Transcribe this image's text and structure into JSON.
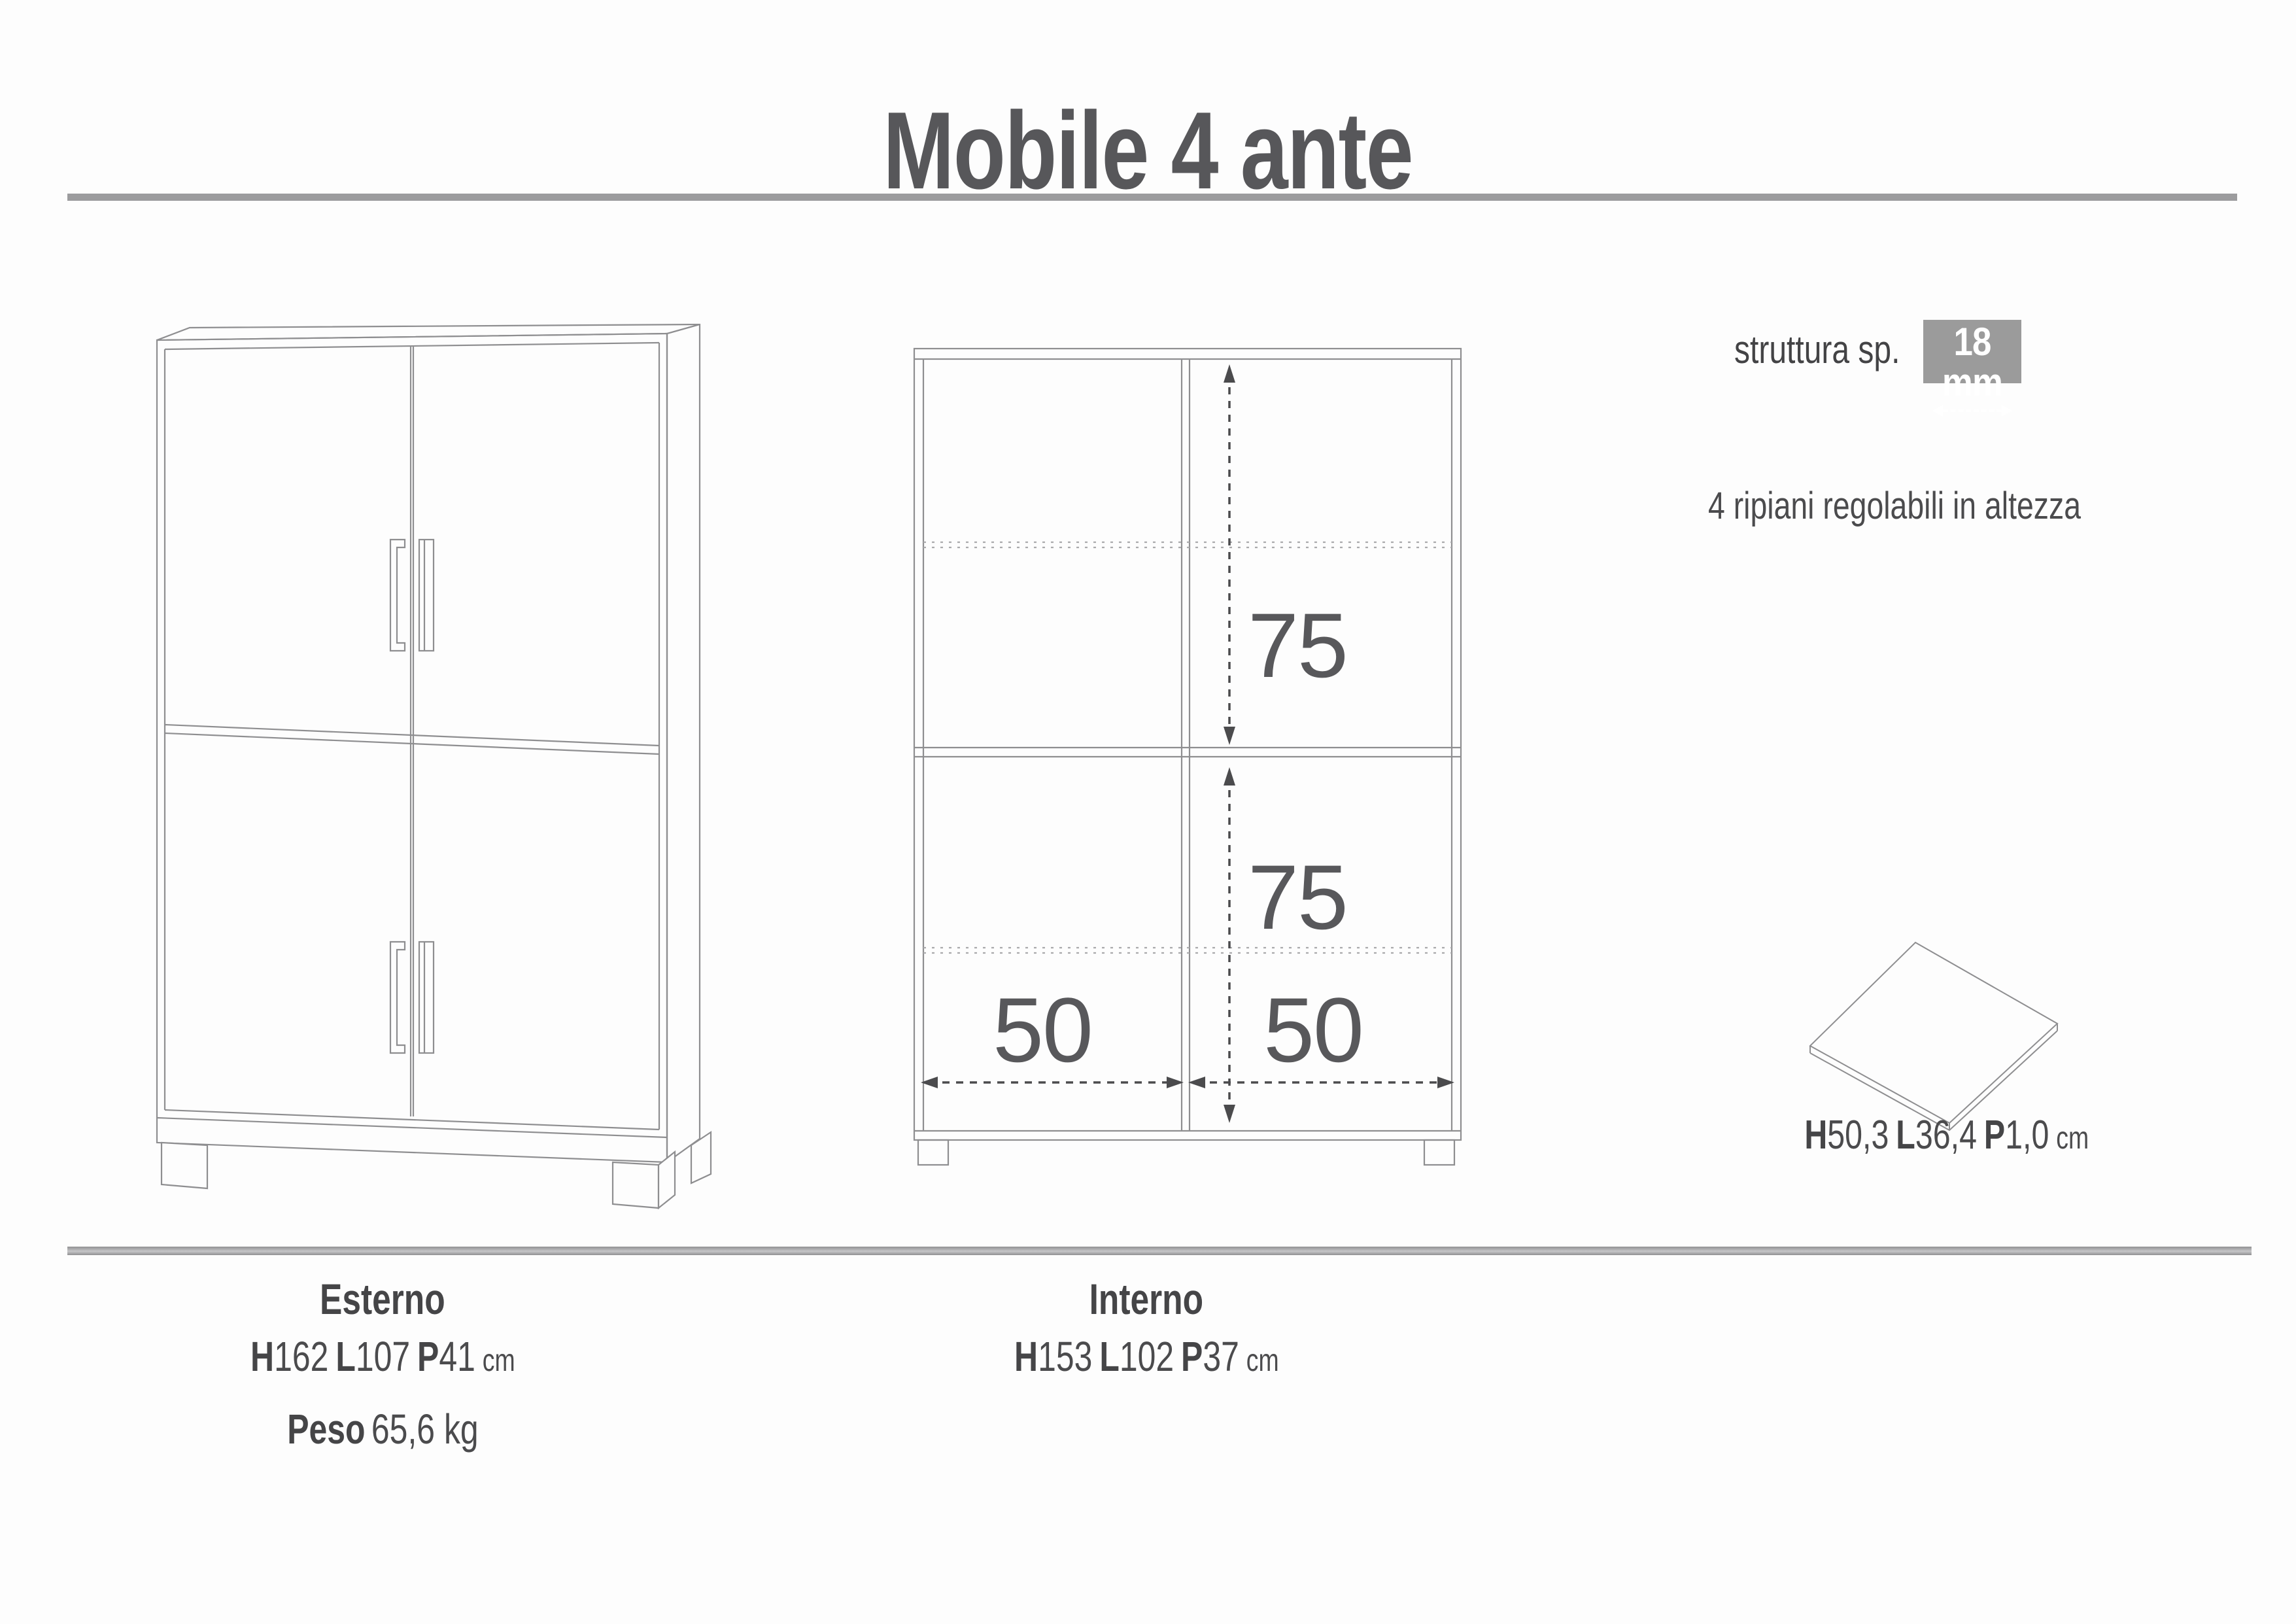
{
  "title": "Mobile 4 ante",
  "structure": {
    "label": "struttura sp.",
    "thickness": "18 mm",
    "note": "4 ripiani regolabili in altezza"
  },
  "front_view": {
    "dim_top": "75",
    "dim_bottom": "75",
    "dim_left": "50",
    "dim_right": "50"
  },
  "shelf": {
    "dims": [
      {
        "k": "H",
        "v": "50,3"
      },
      {
        "k": "L",
        "v": "36,4"
      },
      {
        "k": "P",
        "v": "1,0"
      }
    ],
    "unit": "cm"
  },
  "esterno": {
    "label": "Esterno",
    "dims": [
      {
        "k": "H",
        "v": "162"
      },
      {
        "k": "L",
        "v": "107"
      },
      {
        "k": "P",
        "v": "41"
      }
    ],
    "unit": "cm",
    "peso_label": "Peso",
    "peso_value": "65,6 kg"
  },
  "interno": {
    "label": "Interno",
    "dims": [
      {
        "k": "H",
        "v": "153"
      },
      {
        "k": "L",
        "v": "102"
      },
      {
        "k": "P",
        "v": "37"
      }
    ],
    "unit": "cm"
  },
  "colors": {
    "line": "#8e8e90",
    "dimension": "#4b4b4d",
    "text": "#505052",
    "badge_bg": "#9b9b9b"
  }
}
